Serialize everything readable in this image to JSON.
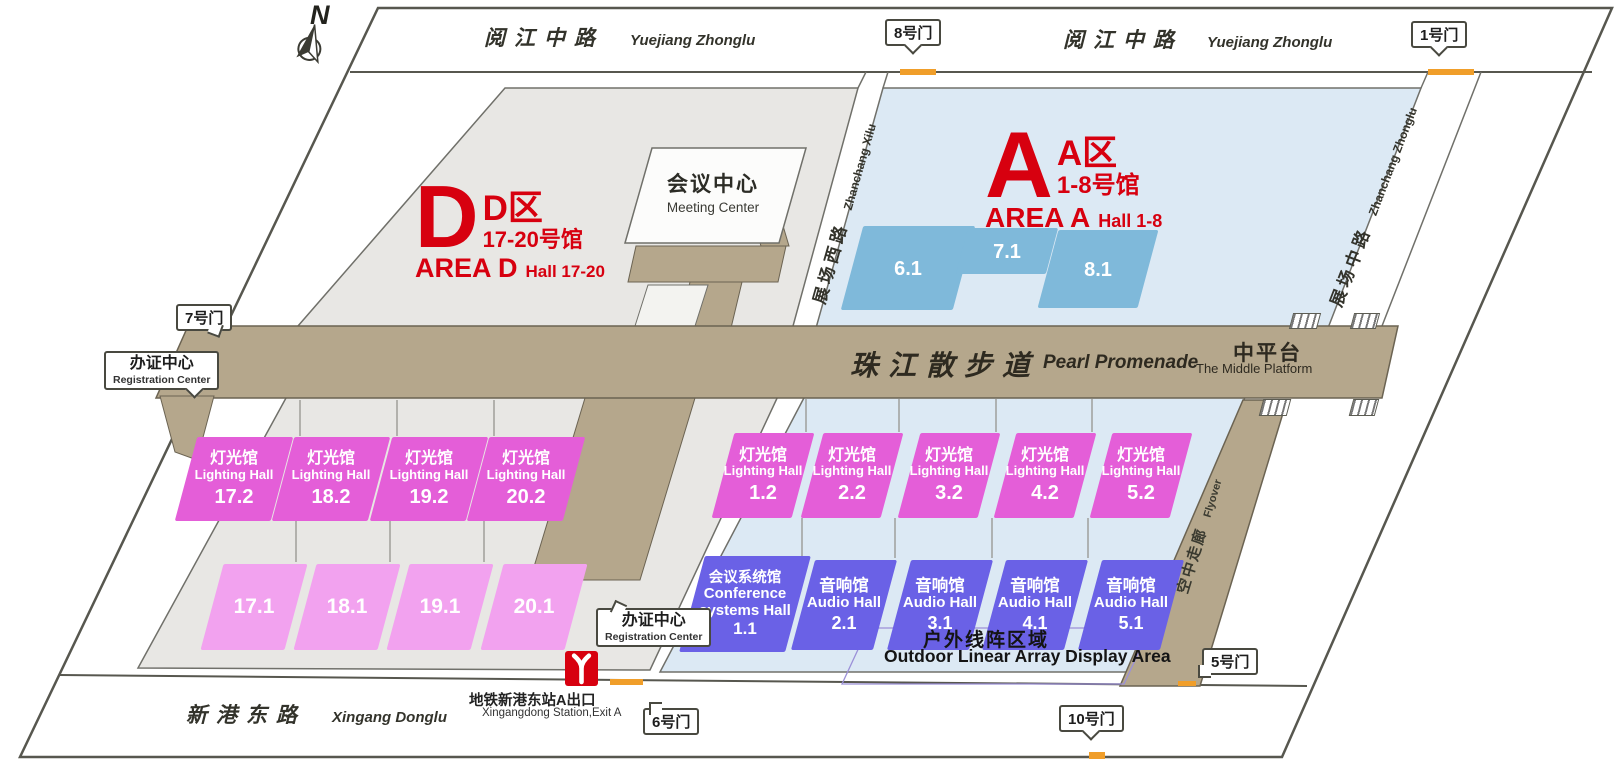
{
  "colors": {
    "red": "#d7000f",
    "orange": "#f09e2a",
    "magenta": "#e45ed8",
    "pink": "#f2a2ef",
    "audio": "#6a61e6",
    "hallblue": "#7fb9da",
    "tan": "#b5a78c",
    "areaD": "#e8e7e4",
    "areaA": "#dce9f4",
    "line": "#57574f",
    "outline": "#70706a",
    "tanline": "#6b6352",
    "outdoorline": "#9b90d8"
  },
  "compass": {
    "label": "N"
  },
  "roads": {
    "yuejiang": {
      "zh": "阅江中路",
      "en": "Yuejiang Zhonglu"
    },
    "xingang": {
      "zh": "新港东路",
      "en": "Xingang Donglu"
    },
    "zhanchang_xilu": {
      "zh": "展场西路",
      "en": "Zhanchang Xilu"
    },
    "zhanchang_zhonglu": {
      "zh": "展场中路",
      "en": "Zhanchang Zhonglu"
    }
  },
  "gates": {
    "g1": "1号门",
    "g5": "5号门",
    "g6": "6号门",
    "g7": "7号门",
    "g8": "8号门",
    "g10": "10号门"
  },
  "areas": {
    "d": {
      "letter": "D",
      "zone_zh": "D区",
      "halls_zh": "17-20号馆",
      "zone_en": "AREA D",
      "halls_en": "Hall 17-20"
    },
    "a": {
      "letter": "A",
      "zone_zh": "A区",
      "halls_zh": "1-8号馆",
      "zone_en": "AREA A",
      "halls_en": "Hall 1-8"
    }
  },
  "landmarks": {
    "meeting_center": {
      "zh": "会议中心",
      "en": "Meeting Center"
    },
    "promenade": {
      "zh": "珠江散步道",
      "en": "Pearl Promenade"
    },
    "middle_platform": {
      "zh": "中平台",
      "en": "The Middle Platform"
    },
    "flyover": {
      "zh": "空中走廊",
      "en": "Flyover"
    },
    "registration": {
      "zh": "办证中心",
      "en": "Registration Center"
    },
    "metro": {
      "zh": "地铁新港东站A出口",
      "en": "Xingangdong Station,Exit A"
    },
    "outdoor": {
      "zh": "户外线阵区域",
      "en": "Outdoor Linear Array Display Area"
    }
  },
  "halls": {
    "lighting_label": {
      "zh": "灯光馆",
      "en": "Lighting Hall"
    },
    "audio_label": {
      "zh": "音响馆",
      "en": "Audio Hall"
    },
    "conference": {
      "zh": "会议系统馆",
      "en_line1": "Conference",
      "en_line2": "systems Hall",
      "id": "1.1"
    },
    "a_top": [
      {
        "id": "6.1"
      },
      {
        "id": "7.1"
      },
      {
        "id": "8.1"
      }
    ],
    "d_lighting": [
      {
        "id": "17.2"
      },
      {
        "id": "18.2"
      },
      {
        "id": "19.2"
      },
      {
        "id": "20.2"
      }
    ],
    "d_lower": [
      {
        "id": "17.1"
      },
      {
        "id": "18.1"
      },
      {
        "id": "19.1"
      },
      {
        "id": "20.1"
      }
    ],
    "a_lighting": [
      {
        "id": "1.2"
      },
      {
        "id": "2.2"
      },
      {
        "id": "3.2"
      },
      {
        "id": "4.2"
      },
      {
        "id": "5.2"
      }
    ],
    "a_audio": [
      {
        "id": "2.1"
      },
      {
        "id": "3.1"
      },
      {
        "id": "4.1"
      },
      {
        "id": "5.1"
      }
    ]
  }
}
